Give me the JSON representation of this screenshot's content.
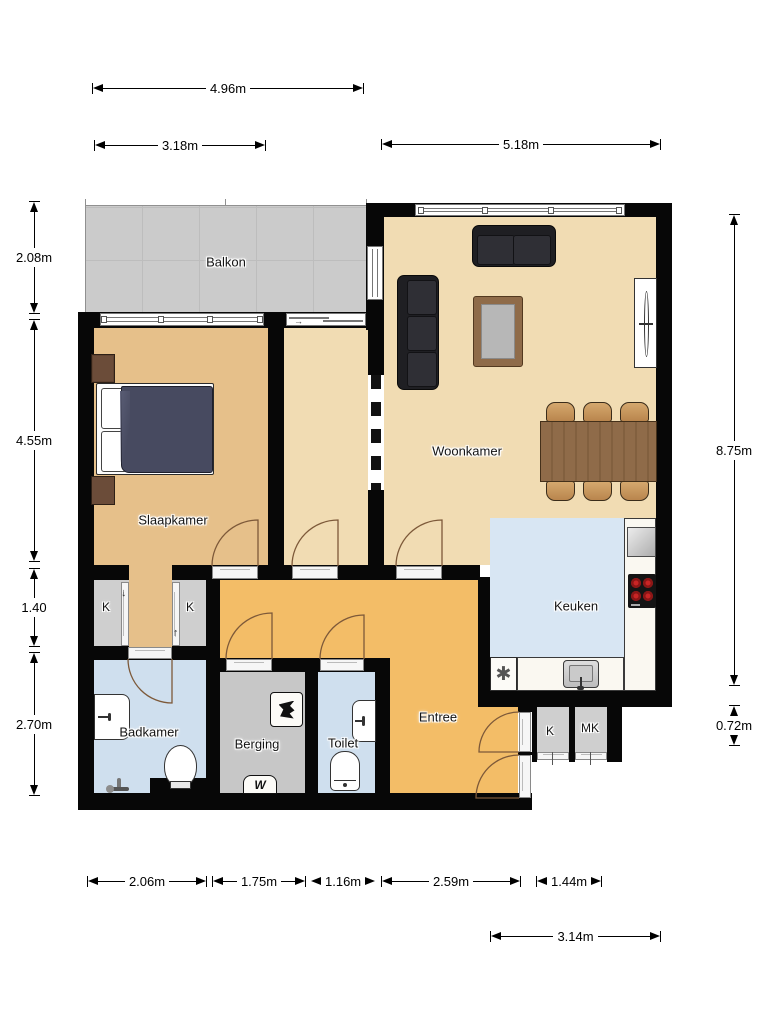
{
  "plan_title": "Apartment floor plan",
  "rooms": {
    "balkon": "Balkon",
    "slaapkamer": "Slaapkamer",
    "woonkamer": "Woonkamer",
    "keuken": "Keuken",
    "badkamer": "Badkamer",
    "berging": "Berging",
    "toilet": "Toilet",
    "entree": "Entree"
  },
  "closets": [
    "K",
    "K",
    "K",
    "MK"
  ],
  "dimensions": {
    "top": [
      "4.96m",
      "3.18m",
      "5.18m"
    ],
    "left": [
      "2.08m",
      "4.55m",
      "1.40",
      "2.70m"
    ],
    "right": [
      "8.75m",
      "0.72m"
    ],
    "bottom": [
      "2.06m",
      "1.75m",
      "1.16m",
      "2.59m",
      "1.44m",
      "3.14m"
    ]
  },
  "icons": {
    "dishwasher": "✱",
    "washing_machine": "W",
    "sliding_door_arrow": "→",
    "closet_arrow_down": "↓",
    "closet_arrow_up": "↑"
  },
  "colors": {
    "wall": "#070707",
    "balcony": "#cbcbcb",
    "bedroom": "#e6c08a",
    "living": "#f1dcb3",
    "hall": "#f3bd67",
    "bathroom": "#cfdfee",
    "kitchen": "#d8e6f3",
    "storage": "#c7c7c7",
    "closet": "#cfcfcf",
    "counter": "#faf8f1",
    "table_wood": "#8f6b49",
    "chair_wood": "#c6975f",
    "sofa": "#202024",
    "duvet": "#474a60",
    "door_arc": "#7d5939"
  }
}
